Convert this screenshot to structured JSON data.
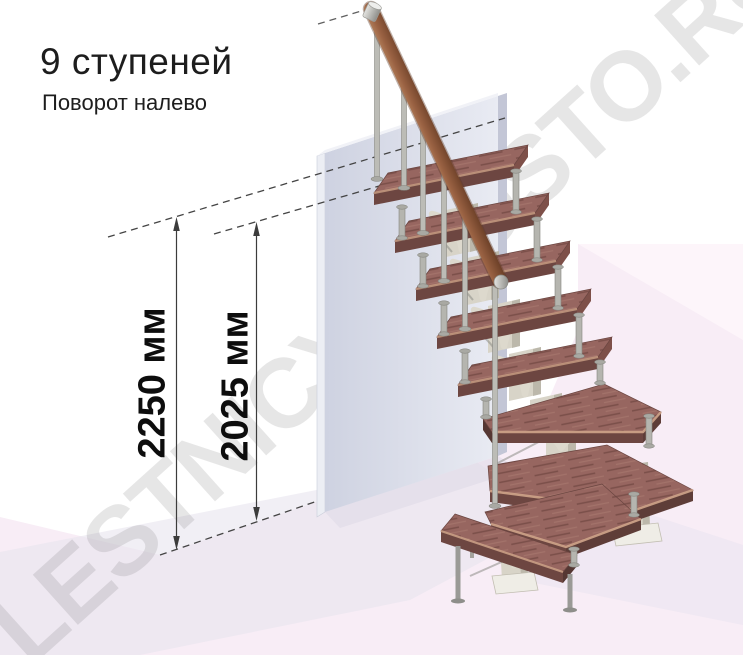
{
  "header": {
    "title": "9 ступеней",
    "subtitle": "Поворот налево"
  },
  "dimensions": {
    "total_height_label": "2250 мм",
    "steps_height_label": "2025 мм"
  },
  "watermark": "LESTNICYPROSTO.RU",
  "scene": {
    "description": "3D render of a modular staircase with 9 steps turning left, against a wall, with two vertical dimension lines",
    "steps_count": 9,
    "straight_treads": 5,
    "winder_treads": 3,
    "bottom_tread": 1,
    "colors": {
      "tread_wood": "#976660",
      "tread_front": "#6d4641",
      "tread_edge_light": "#c69b81",
      "handrail_wood": "#8a5137",
      "metal_post": "#bcbcb6",
      "spine_column": "#d8d4c8",
      "wall": "#d6d9e6",
      "floor_pink": "#f8edf6",
      "shadow_lavender": "#e8e4ef",
      "dimension_line": "#3c3c3c"
    }
  }
}
